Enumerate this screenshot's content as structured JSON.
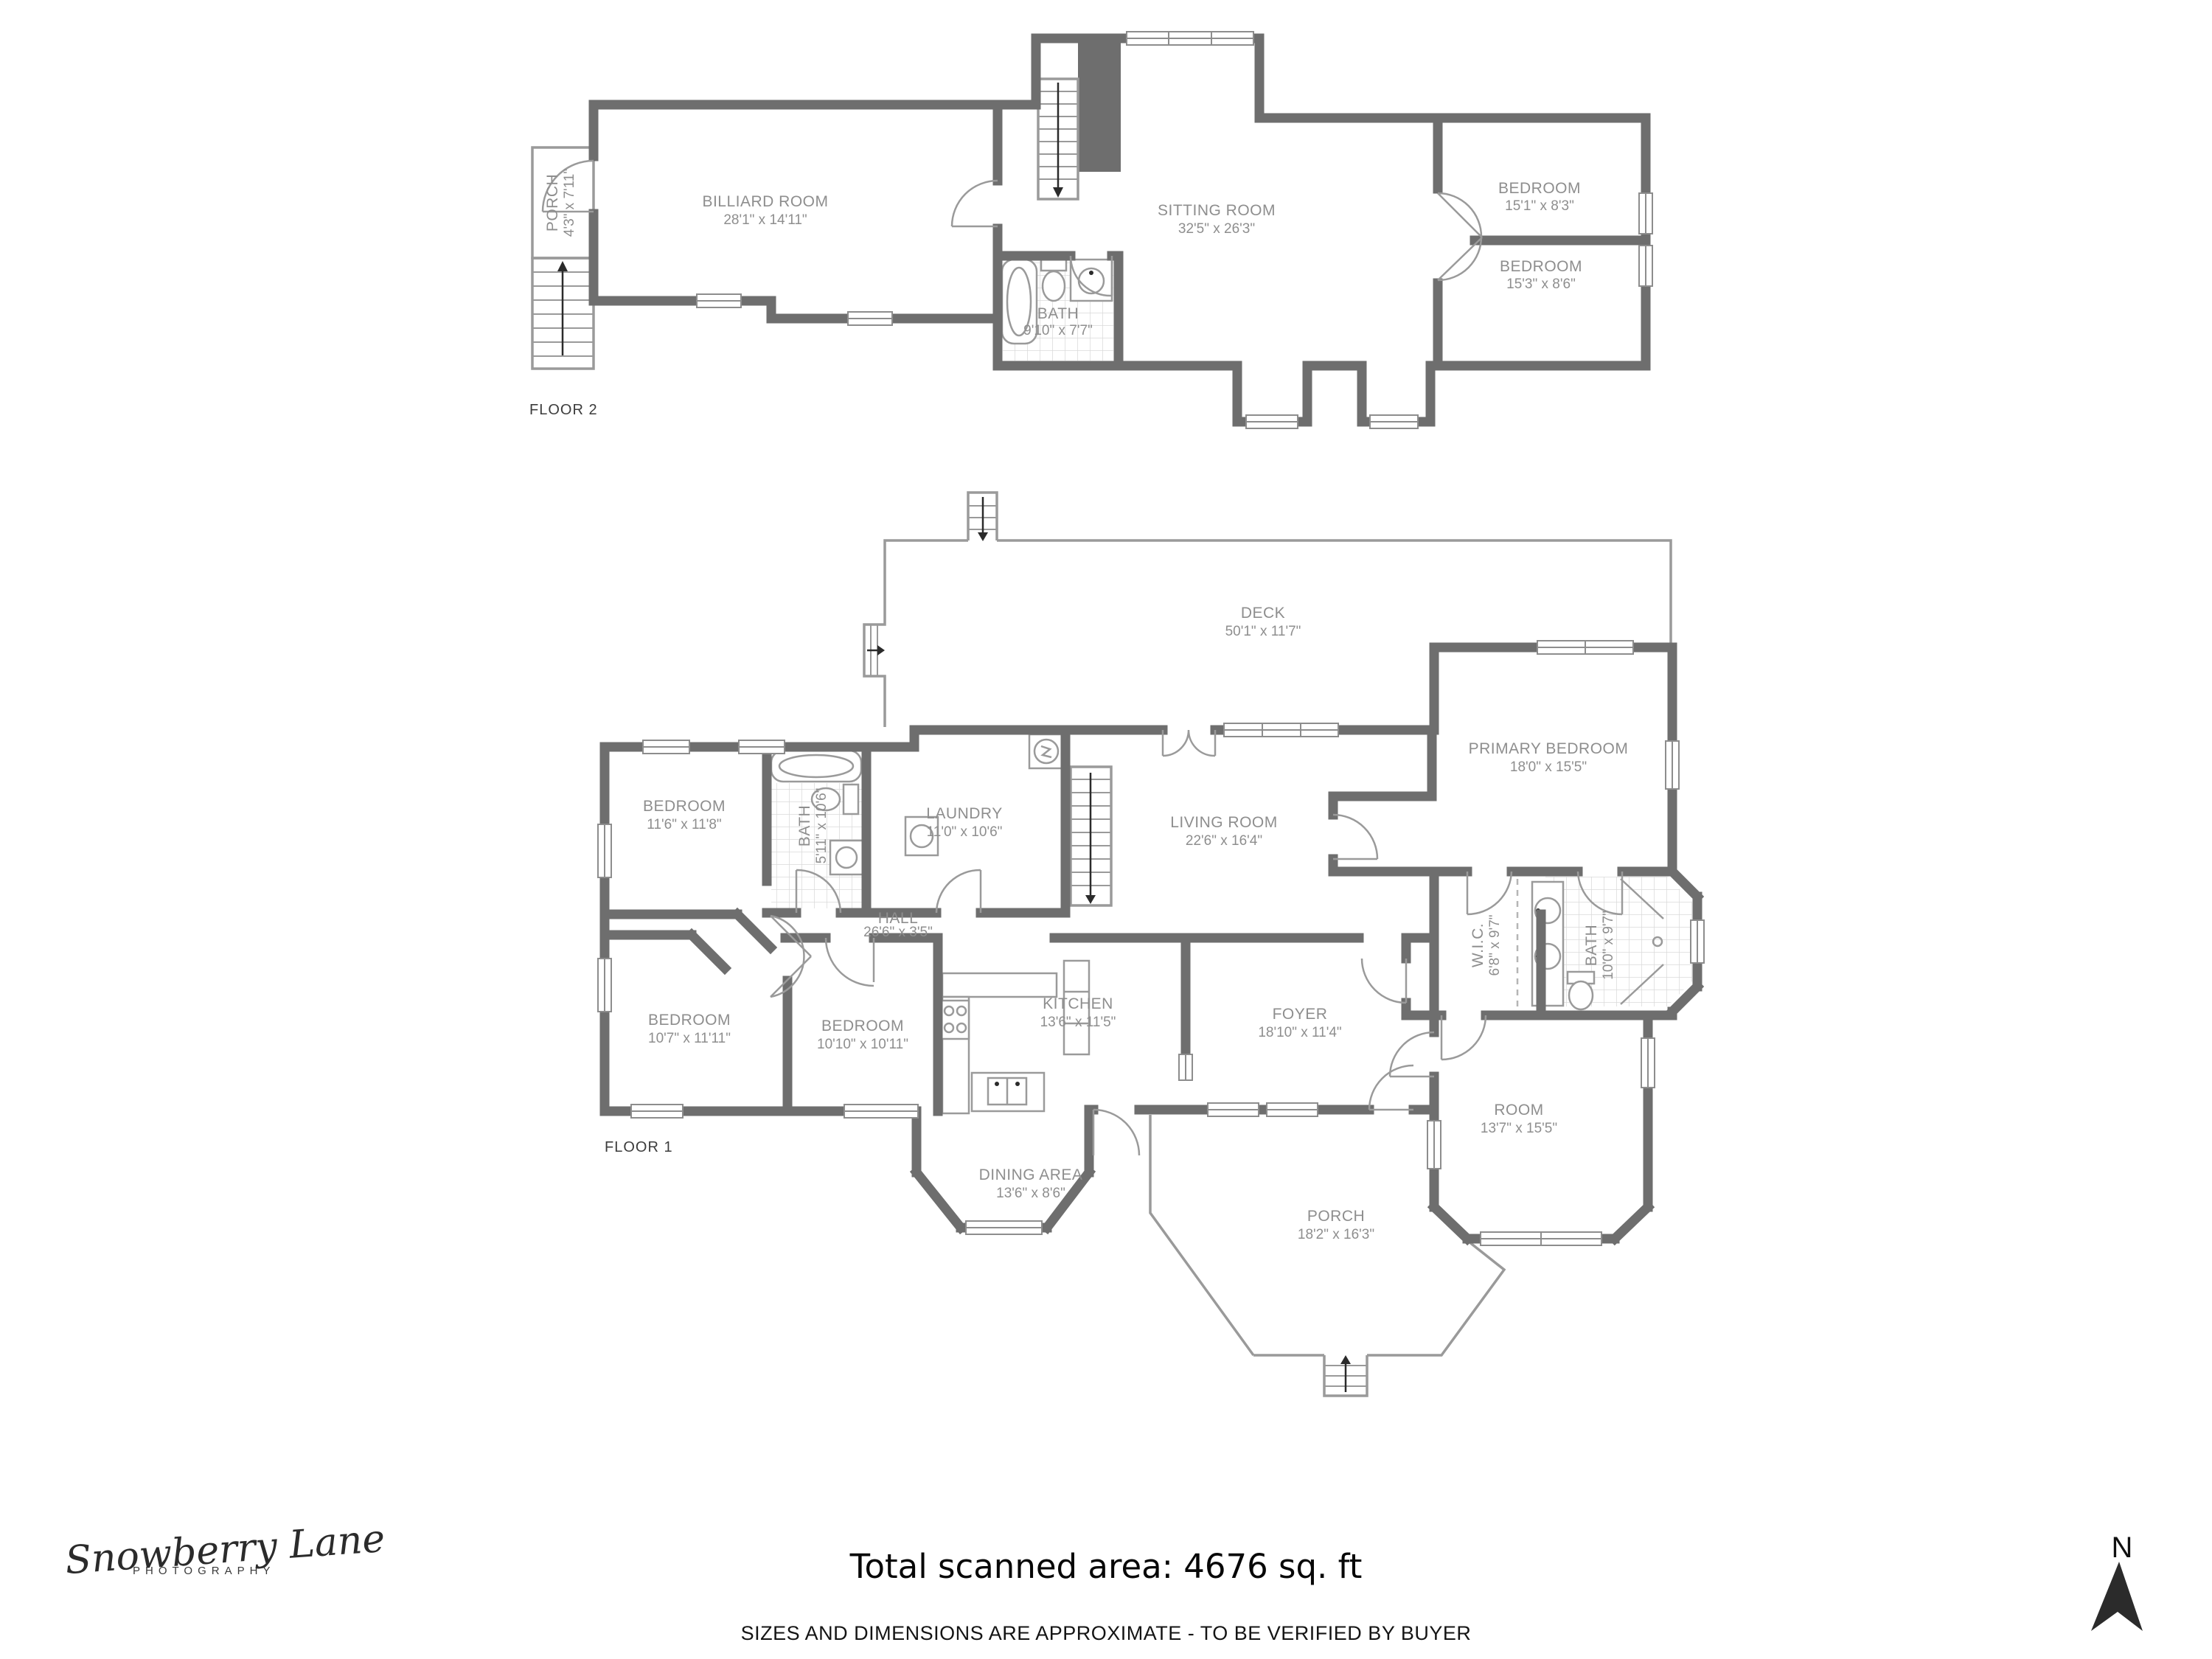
{
  "floor2": {
    "label": "FLOOR 2",
    "rooms": [
      {
        "name": "PORCH",
        "dims": "4'3\" x 7'11\""
      },
      {
        "name": "BILLIARD ROOM",
        "dims": "28'1\" x 14'11\""
      },
      {
        "name": "SITTING ROOM",
        "dims": "32'5\" x 26'3\""
      },
      {
        "name": "BATH",
        "dims": "9'10\" x 7'7\""
      },
      {
        "name": "BEDROOM",
        "dims": "15'1\" x 8'3\""
      },
      {
        "name": "BEDROOM",
        "dims": "15'3\" x 8'6\""
      }
    ]
  },
  "floor1": {
    "label": "FLOOR 1",
    "rooms": [
      {
        "name": "DECK",
        "dims": "50'1\" x 11'7\""
      },
      {
        "name": "PRIMARY BEDROOM",
        "dims": "18'0\" x 15'5\""
      },
      {
        "name": "LIVING ROOM",
        "dims": "22'6\" x 16'4\""
      },
      {
        "name": "BEDROOM",
        "dims": "11'6\" x 11'8\""
      },
      {
        "name": "BATH",
        "dims": "5'11\" x 10'6\""
      },
      {
        "name": "LAUNDRY",
        "dims": "11'0\" x 10'6\""
      },
      {
        "name": "HALL",
        "dims": "26'6\" x 3'5\""
      },
      {
        "name": "BEDROOM",
        "dims": "10'7\" x 11'11\""
      },
      {
        "name": "BEDROOM",
        "dims": "10'10\" x 10'11\""
      },
      {
        "name": "KITCHEN",
        "dims": "13'6\" x 11'5\""
      },
      {
        "name": "FOYER",
        "dims": "18'10\" x 11'4\""
      },
      {
        "name": "W.I.C.",
        "dims": "6'8\" x 9'7\""
      },
      {
        "name": "BATH",
        "dims": "10'0\" x 9'7\""
      },
      {
        "name": "ROOM",
        "dims": "13'7\" x 15'5\""
      },
      {
        "name": "DINING AREA",
        "dims": "13'6\" x 8'6\""
      },
      {
        "name": "PORCH",
        "dims": "18'2\" x 16'3\""
      }
    ]
  },
  "footer": {
    "total_area": "Total scanned area: 4676 sq. ft",
    "disclaimer": "SIZES AND DIMENSIONS ARE APPROXIMATE - TO BE VERIFIED BY BUYER"
  },
  "logo": {
    "brand": "Snowberry Lane",
    "sub": "PHOTOGRAPHY"
  },
  "compass": {
    "label": "N"
  }
}
